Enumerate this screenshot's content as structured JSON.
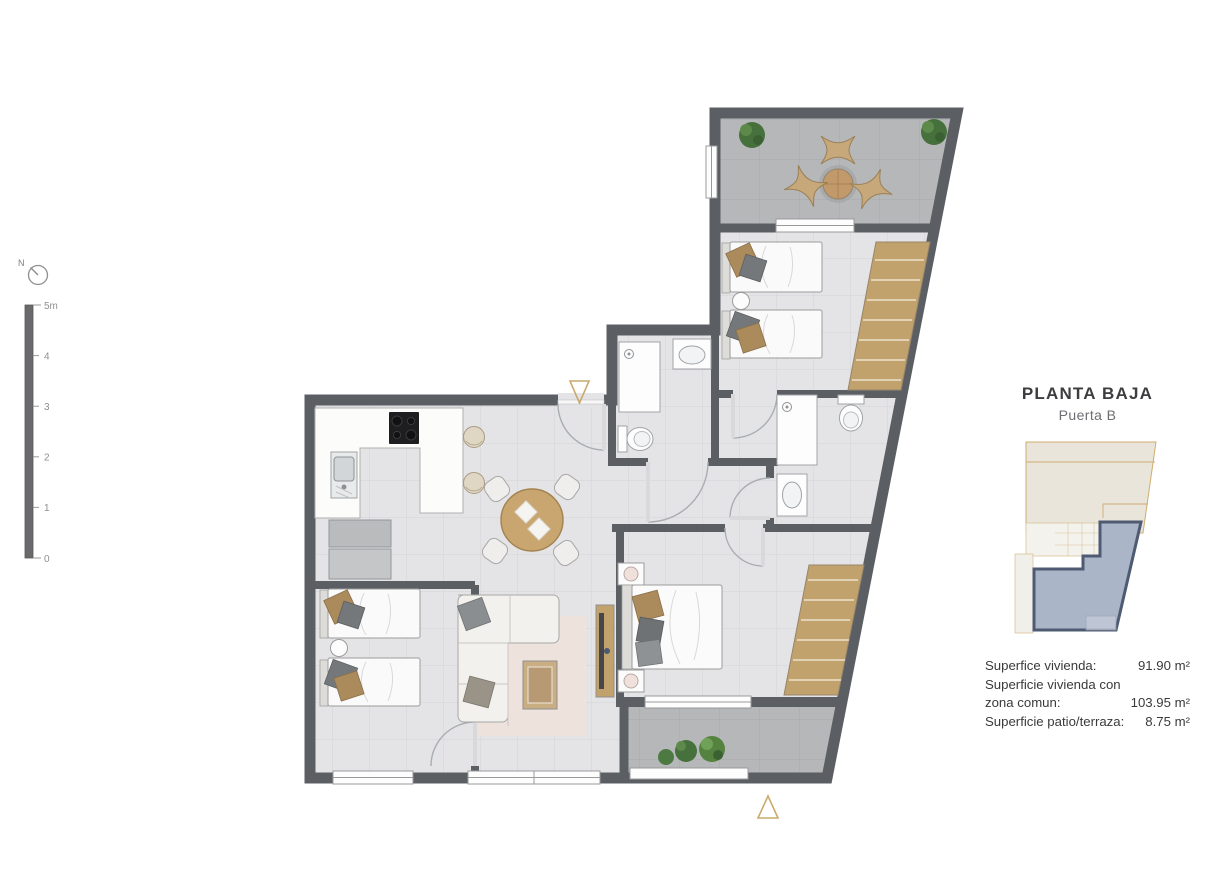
{
  "compass": {
    "label": "N"
  },
  "scale_bar": {
    "top_label": "5m",
    "ticks": [
      "4",
      "3",
      "2",
      "1",
      "0"
    ]
  },
  "panel": {
    "title": "PLANTA BAJA",
    "subtitle": "Puerta B",
    "areas": [
      {
        "label": "Superfice vivienda:",
        "value": "91.90 m²"
      },
      {
        "label": "Superficie vivienda con",
        "value": ""
      },
      {
        "label": "zona comun:",
        "value": "103.95 m²"
      },
      {
        "label": "Superficie patio/terraza:",
        "value": "8.75 m²"
      }
    ]
  },
  "markers": {
    "top_entrance": "triangle-down",
    "bottom_entrance": "triangle-up"
  },
  "colors": {
    "wall": "#5b5f64",
    "indoor_floor": "#e4e4e6",
    "outdoor_floor": "#b6b7b9",
    "wood": "#c1a26d",
    "accent_tan": "#c9aa6c",
    "plant_green": "#4c7a42",
    "minimap_highlight": "#abb5c8",
    "minimap_outline": "#4f5b72",
    "minimap_beige": "#e9e5db",
    "minimap_line_tan": "#cfac72"
  }
}
